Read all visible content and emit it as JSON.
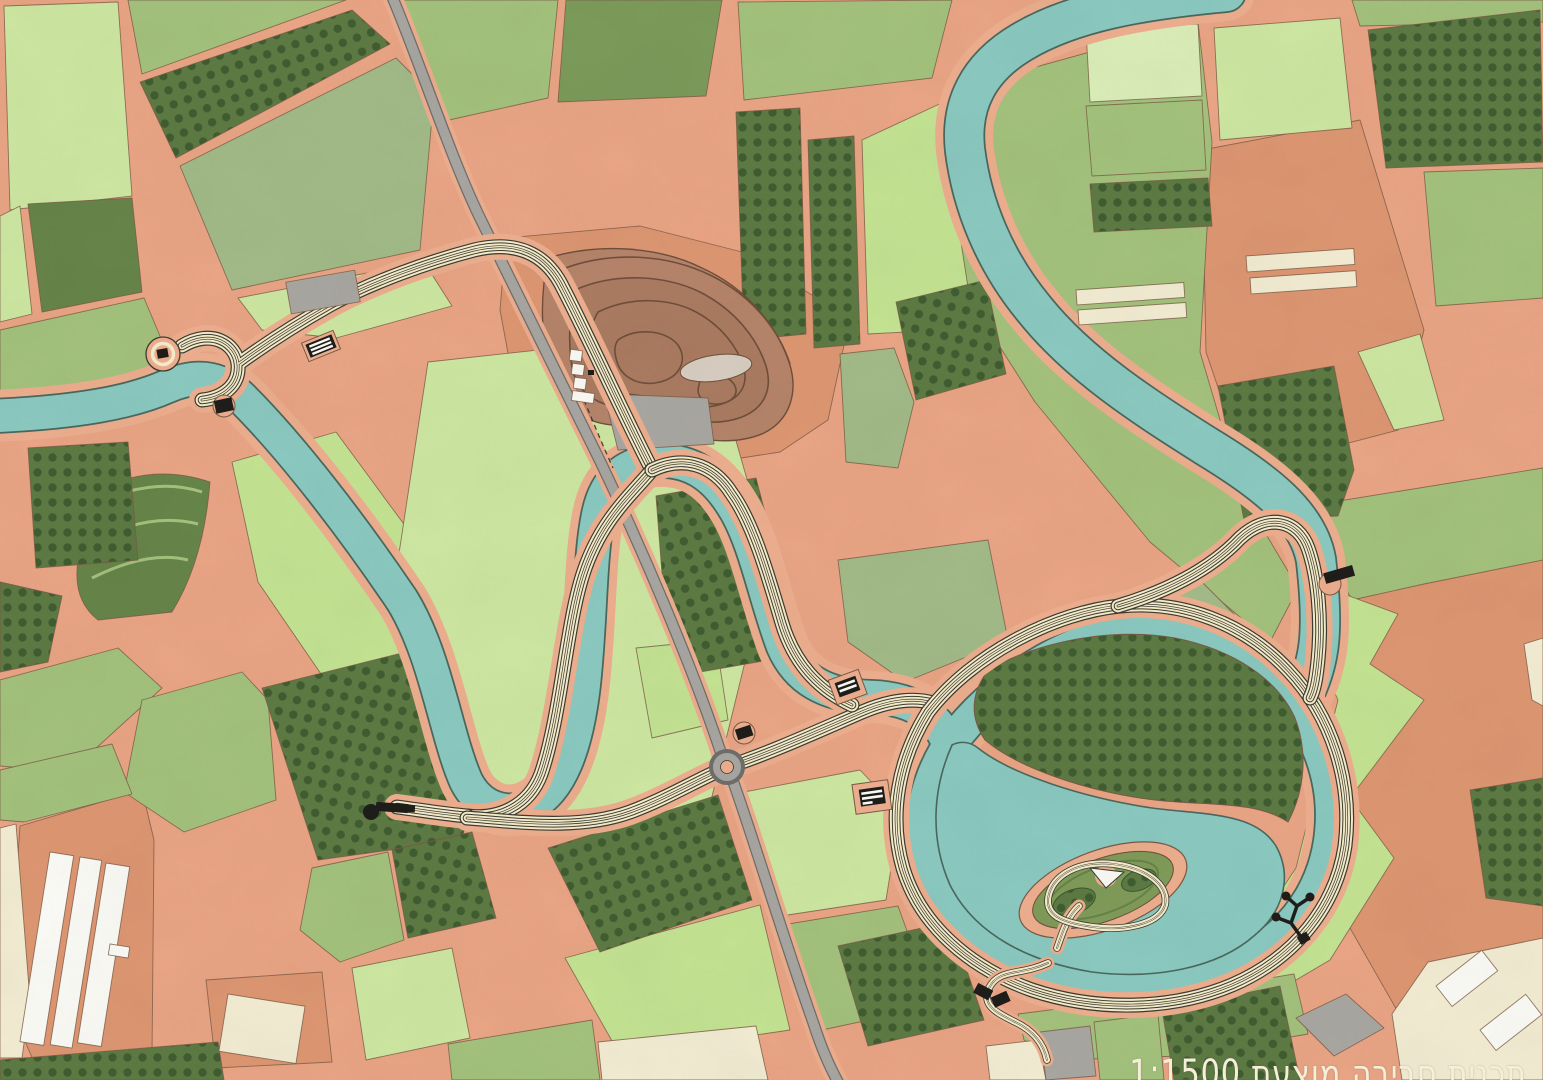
{
  "caption": {
    "text": "תכנית סביבה מוצעת 1:1500",
    "scale": "1:1500"
  },
  "colors": {
    "salmon": "#e9a585",
    "salmon_deep": "#dd9672",
    "bank": "#ecae8e",
    "river": "#8ac9c1",
    "river_edge": "#4a685e",
    "track": "#f4ecca",
    "ink": "#3c3a31",
    "road": "#a8a6a2",
    "road_edge": "#6f6e6a",
    "field_light": "#cde7a2",
    "field_lighter": "#daedb8",
    "field_bright": "#c3e392",
    "field_mid": "#a3c27c",
    "field_sage": "#a2ba88",
    "field_dark": "#7b9b5a",
    "field_darker": "#668549",
    "orchard": "#5d7a44",
    "orchard_dot": "#3d5a2f",
    "cream": "#f2ecd3",
    "white": "#fafaf6",
    "gray": "#a9a7a2",
    "brown": "#b5846a",
    "brown_line": "#6f4f3b",
    "outline": "#7a5a45",
    "black": "#1e1d1a",
    "island_green": "#7f9b59"
  },
  "features": [
    "agricultural-field-parcels",
    "orchard-groves",
    "winding-stream",
    "oxbow-lake",
    "lake-island-garden",
    "promenade-track",
    "rural-highway",
    "roundabout",
    "terraced-earthworks",
    "parking-lot",
    "greenhouses",
    "farm-buildings",
    "lookout-pavilions",
    "trailhead-circle"
  ]
}
